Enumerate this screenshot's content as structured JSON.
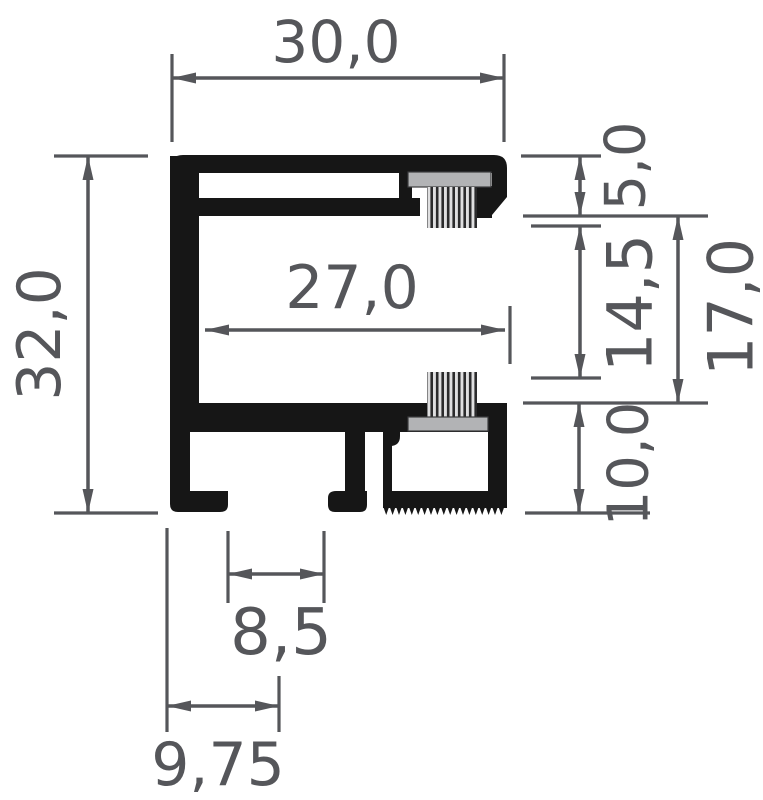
{
  "figure": {
    "kind": "profile-cross-section-drawing",
    "decimal_separator": ","
  },
  "colors": {
    "background": "#ffffff",
    "profile": "#161616",
    "dimension_lines": "#55565a",
    "brush_holder": "#b2b3b5",
    "bristle_dark": "#2b2b2c",
    "bristle_light": "#dfdfe0"
  },
  "dimensions": {
    "overall_width": {
      "label": "30,0",
      "orientation": "horizontal"
    },
    "overall_height": {
      "label": "32,0",
      "orientation": "vertical-rotated"
    },
    "inner_width": {
      "label": "27,0",
      "orientation": "horizontal"
    },
    "top_section": {
      "label": "5,0",
      "orientation": "vertical-rotated"
    },
    "brush_opening": {
      "label": "14,5",
      "orientation": "vertical-rotated"
    },
    "side_opening": {
      "label": "17,0",
      "orientation": "vertical-rotated"
    },
    "bottom_section": {
      "label": "10,0",
      "orientation": "vertical-rotated"
    },
    "slot_width": {
      "label": "8,5",
      "orientation": "horizontal"
    },
    "slot_offset": {
      "label": "9,75",
      "orientation": "horizontal"
    }
  }
}
